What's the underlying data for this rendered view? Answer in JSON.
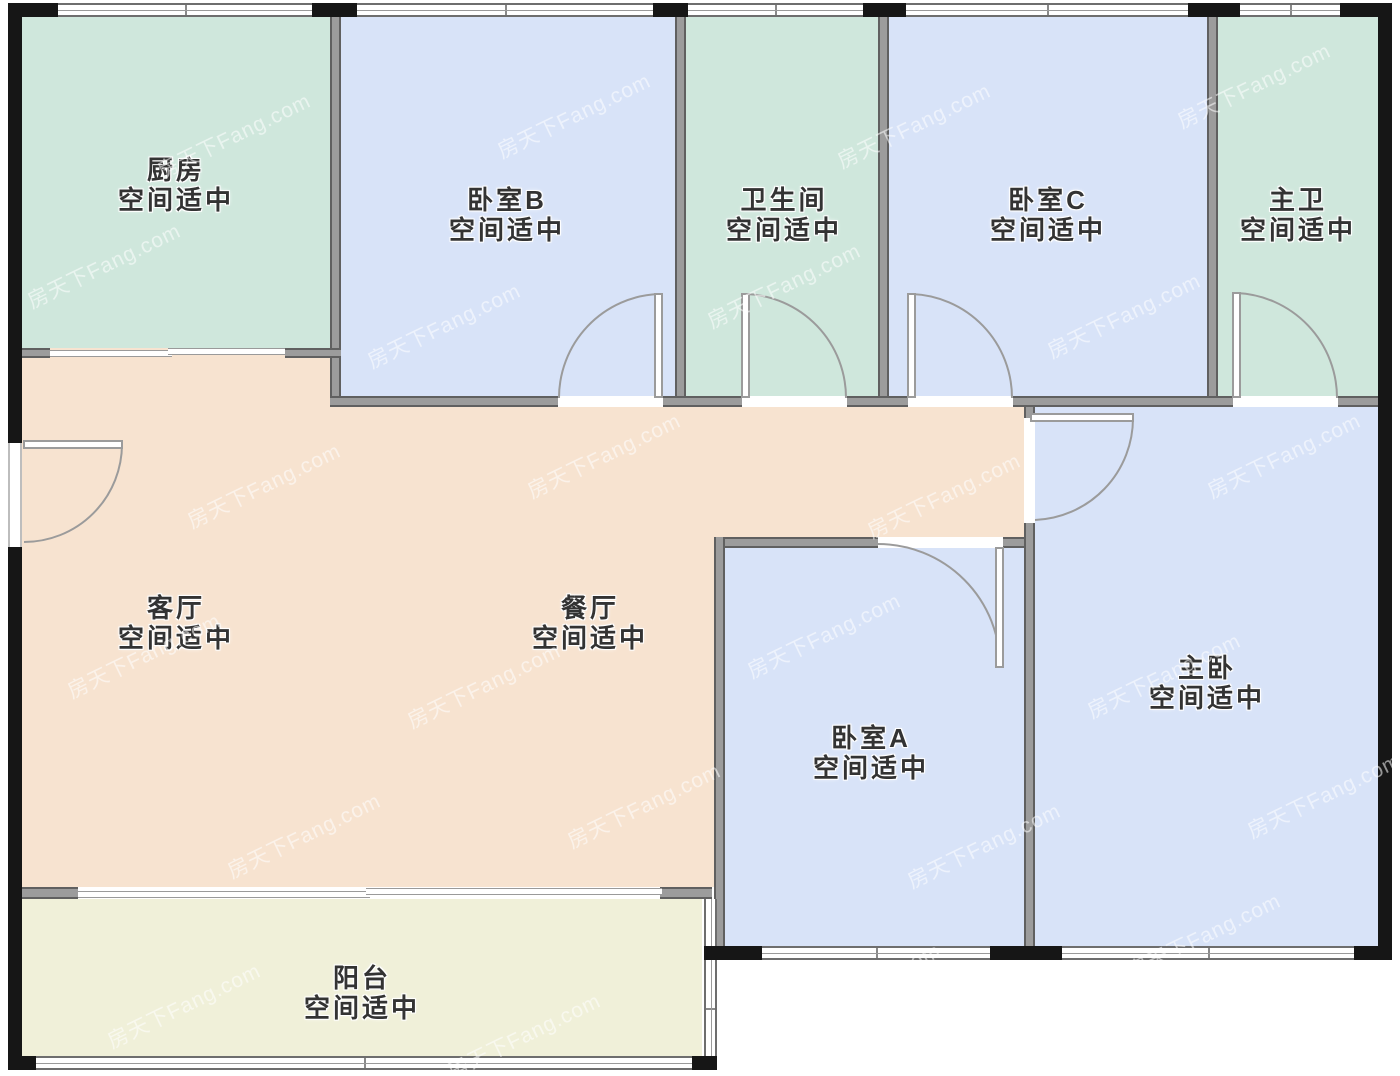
{
  "watermark": {
    "text": "房天下Fang.com"
  },
  "rooms": {
    "kitchen": {
      "name": "厨房",
      "status": "空间适中"
    },
    "bedroom_b": {
      "name": "卧室B",
      "status": "空间适中"
    },
    "bathroom": {
      "name": "卫生间",
      "status": "空间适中"
    },
    "bedroom_c": {
      "name": "卧室C",
      "status": "空间适中"
    },
    "master_bath": {
      "name": "主卫",
      "status": "空间适中"
    },
    "living_room": {
      "name": "客厅",
      "status": "空间适中"
    },
    "dining_room": {
      "name": "餐厅",
      "status": "空间适中"
    },
    "bedroom_a": {
      "name": "卧室A",
      "status": "空间适中"
    },
    "master_bedroom": {
      "name": "主卧",
      "status": "空间适中"
    },
    "balcony": {
      "name": "阳台",
      "status": "空间适中"
    }
  },
  "colors": {
    "room_teal": "#cfe7dc",
    "room_blue": "#d8e3f8",
    "room_peach": "#f7e3d0",
    "room_balcony": "#f0f0d9",
    "exterior_wall": "#161616",
    "interior_wall": "#9c9c9c",
    "door_arc": "#9b9b9b",
    "label_text": "#333333",
    "watermark_color": "rgba(255,255,255,0.55)"
  }
}
